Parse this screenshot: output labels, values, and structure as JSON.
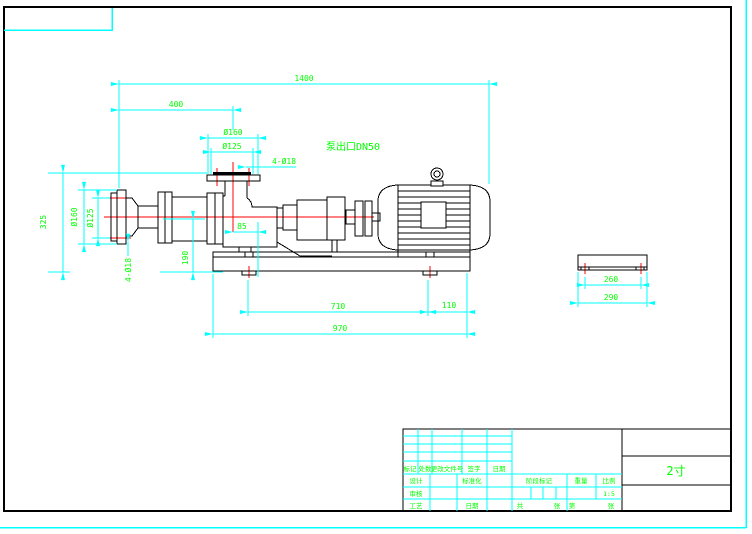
{
  "colors": {
    "background": "#ffffff",
    "geometry": "#000000",
    "dimension_lines": "#00ffff",
    "dimension_text": "#00ff00",
    "centerlines": "#ff0000",
    "outer_border": "#00ffff"
  },
  "drawing": {
    "dims": {
      "overall_length": "1400",
      "inlet_to_outlet": "400",
      "outlet_flange_od": "Ø160",
      "outlet_bolt_circle": "Ø125",
      "outlet_bolt_holes": "4-Ø18",
      "outlet_height": "325",
      "inlet_flange_od": "Ø160",
      "inlet_bolt_circle": "Ø125",
      "inlet_bolt_holes": "4-Ø18",
      "centerline_height": "190",
      "outlet_offset": "85",
      "foot_span": "710",
      "foot_to_end": "110",
      "base_length": "970",
      "base_bolt_span": "260",
      "base_width": "290"
    },
    "notes": {
      "outlet": "泵出口DN50"
    }
  },
  "title_block": {
    "rev_headers": [
      "标记",
      "处数",
      "更改文件号",
      "签字",
      "日期"
    ],
    "left_rows": [
      "设计",
      "审核",
      "工艺"
    ],
    "mid_row1": "标准化",
    "mid_row3": "日期",
    "stage_label": "阶段标记",
    "weight_label": "重量",
    "scale_label": "比例",
    "scale_value": "1:5",
    "sheets": {
      "total_prefix": "共",
      "total_suffix": "张",
      "no_prefix": "第",
      "no_suffix": "张"
    },
    "part_name": "2寸"
  }
}
